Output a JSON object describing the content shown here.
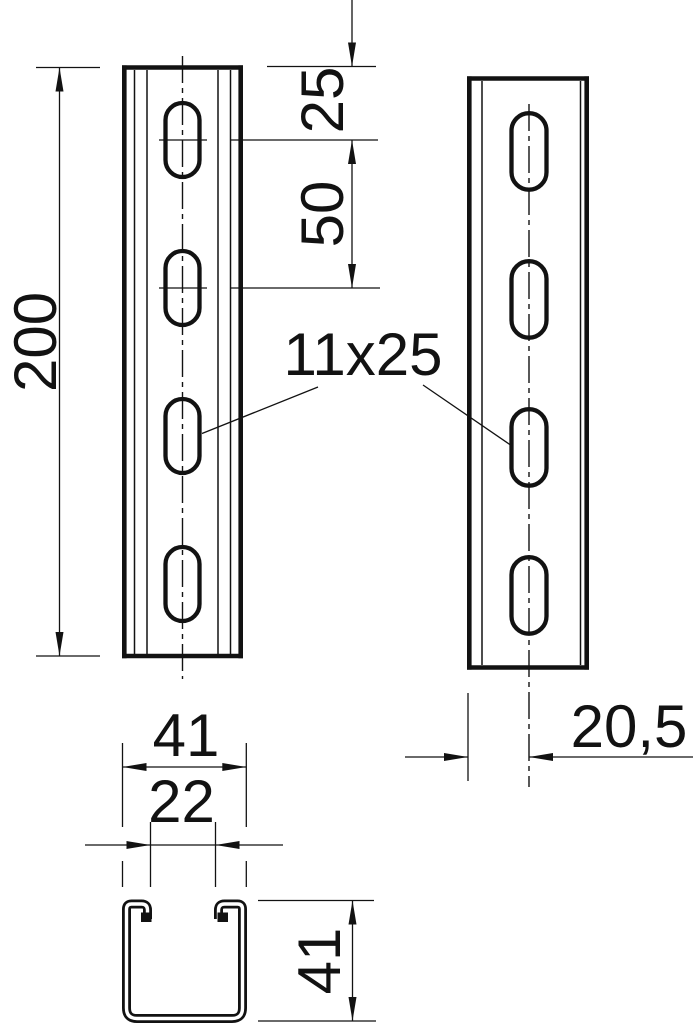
{
  "drawing": {
    "colors": {
      "line": "#121212",
      "background": "#ffffff"
    },
    "labels": {
      "overall_length": "200",
      "end_distance": "25",
      "hole_pitch": "50",
      "slot_size": "11x25",
      "center_offset": "20,5",
      "profile_width": "41",
      "opening_width": "22",
      "profile_height": "41"
    }
  }
}
